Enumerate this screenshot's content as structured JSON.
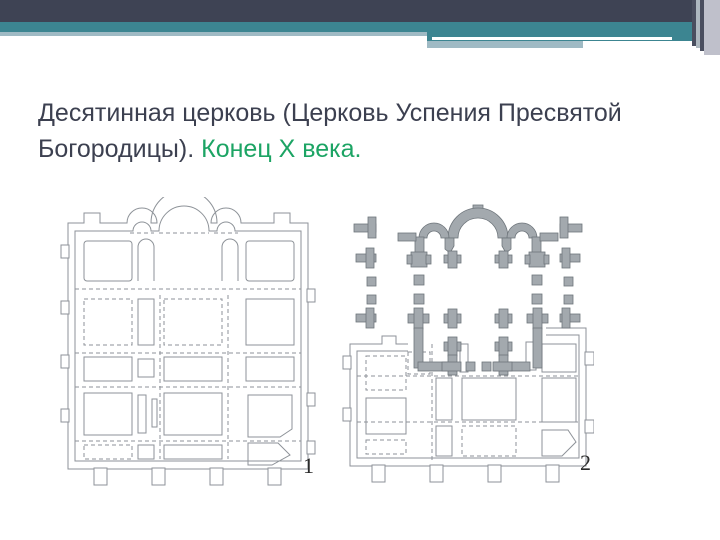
{
  "slide": {
    "title": {
      "main": "Десятинная церковь (Церковь Успения Пресвятой Богородицы).",
      "accent": "Конец X века."
    },
    "figures": [
      {
        "label": "1"
      },
      {
        "label": "2"
      }
    ],
    "theme": {
      "header_dark": "#3E4354",
      "header_teal": "#3C8591",
      "header_light_line": "#9FBAC4",
      "header_lavender_stripe": "#BFC0CB",
      "title_color": "#3C4050",
      "accent_green": "#1CA464",
      "plan_line_gray": "#8D9298",
      "plan_fill_gray": "#A3A9AE"
    }
  }
}
